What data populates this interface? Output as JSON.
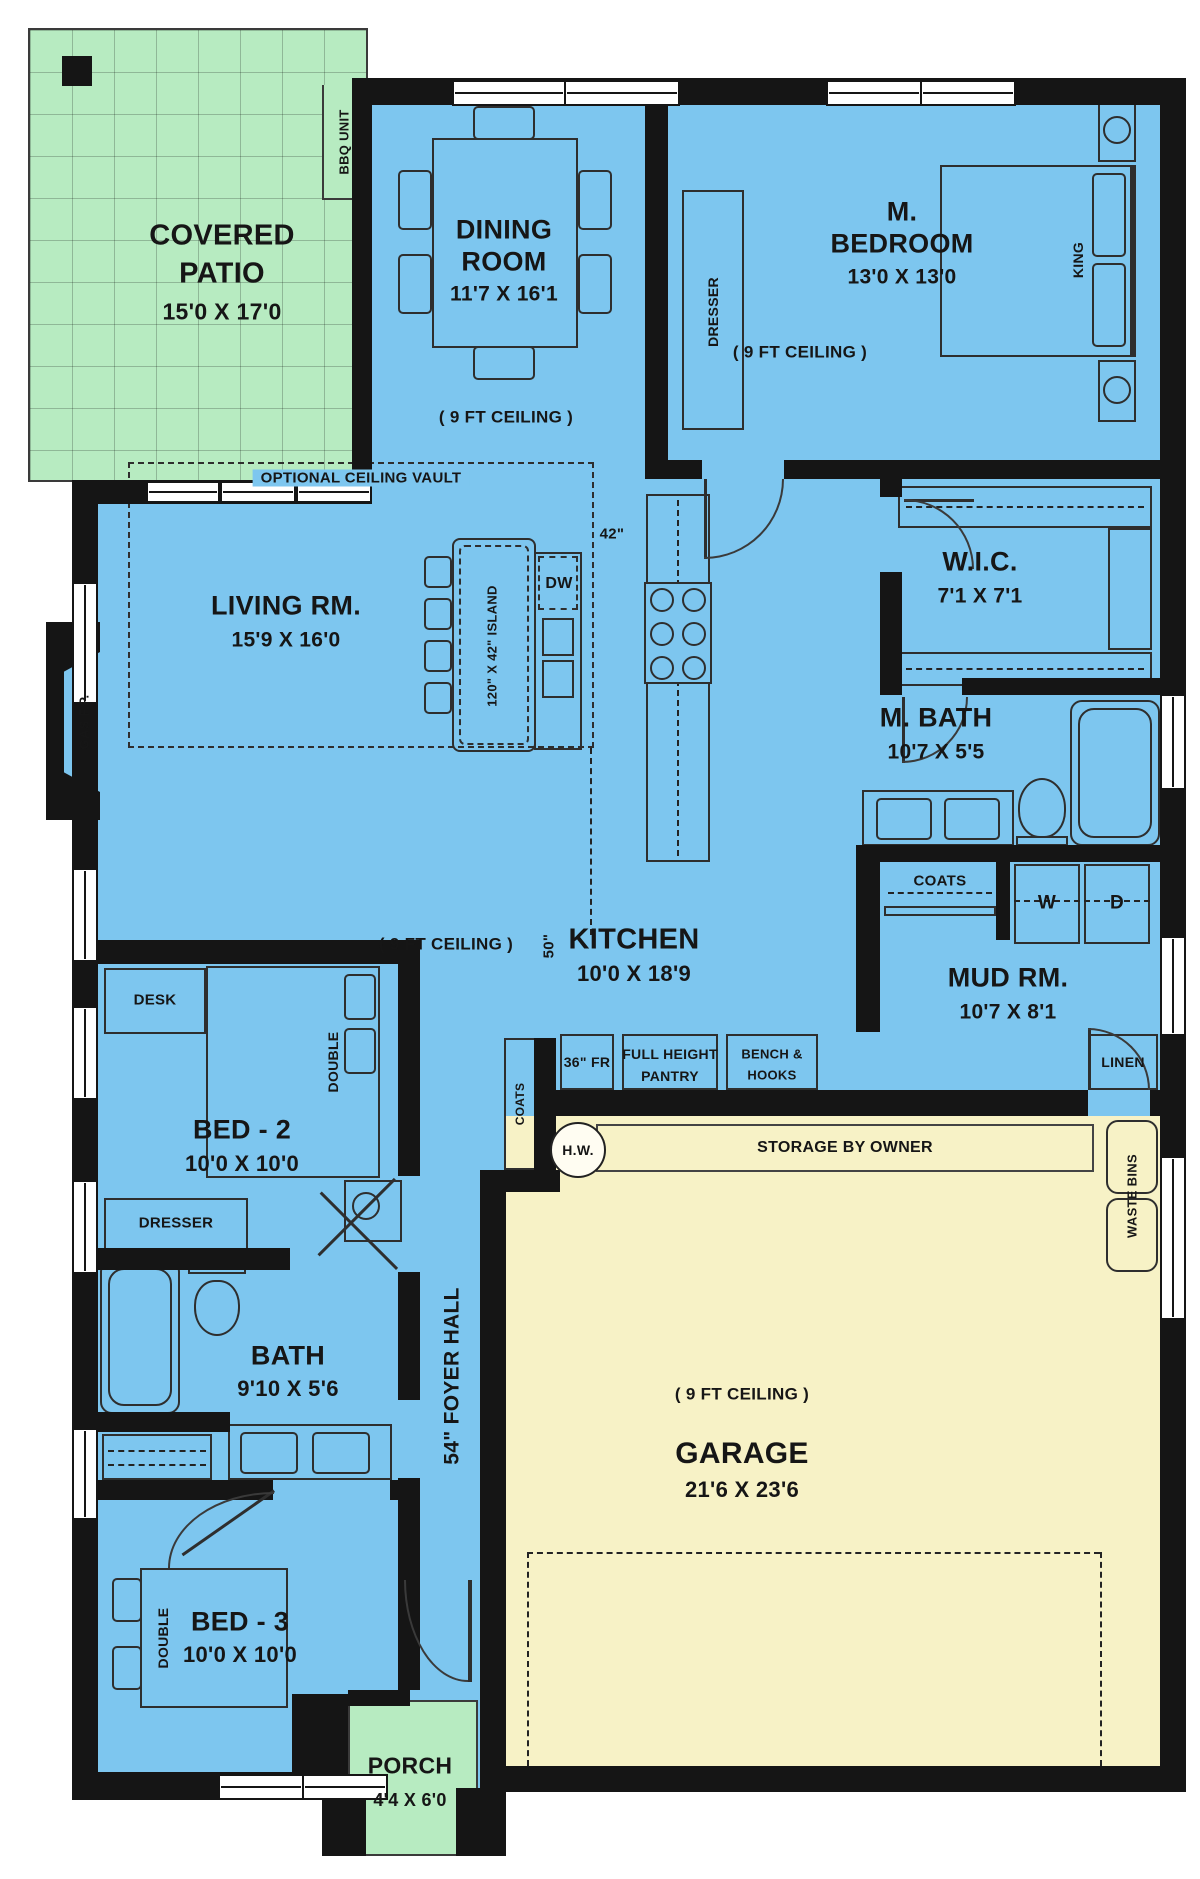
{
  "colors": {
    "interior": "#7dc6ef",
    "patio": "#b7ebc1",
    "garage": "#f7f2c6",
    "wall": "#151515"
  },
  "rooms": {
    "patio": {
      "line1": "COVERED",
      "line2": "PATIO",
      "dims": "15'0 X 17'0",
      "bbq": "BBQ UNIT"
    },
    "dining": {
      "line1": "DINING",
      "line2": "ROOM",
      "dims": "11'7 X 16'1",
      "ceiling": "( 9 FT CEILING )"
    },
    "master": {
      "line1": "M.",
      "line2": "BEDROOM",
      "dims": "13'0 X 13'0",
      "ceiling": "( 9 FT CEILING )",
      "king": "KING",
      "dresser": "DRESSER"
    },
    "wic": {
      "name": "W.I.C.",
      "dims": "7'1 X 7'1"
    },
    "mbath": {
      "name": "M. BATH",
      "dims": "10'7 X 5'5"
    },
    "living": {
      "name": "LIVING RM.",
      "dims": "15'9 X 16'0",
      "vault": "OPTIONAL CEILING VAULT",
      "fireplace": "GAS F.P."
    },
    "kitchen": {
      "name": "KITCHEN",
      "dims": "10'0 X 18'9",
      "ceiling": "( 9 FT CEILING )",
      "island": "120\" X 42\" ISLAND",
      "dw": "DW",
      "note42": "42\"",
      "note50": "50\"",
      "fridge": "36\" FR"
    },
    "pantry": {
      "line1": "FULL HEIGHT",
      "line2": "PANTRY"
    },
    "mud": {
      "name": "MUD RM.",
      "dims": "10'7 X 8'1",
      "washer": "W",
      "dryer": "D",
      "coats_upper": "COATS",
      "coats_foyer": "COATS",
      "bench1": "BENCH &",
      "bench2": "HOOKS",
      "linen": "LINEN"
    },
    "garage": {
      "name": "GARAGE",
      "dims": "21'6 X 23'6",
      "ceiling": "( 9 FT CEILING )",
      "storage": "STORAGE BY OWNER",
      "hw": "H.W.",
      "waste": "WASTE BINS"
    },
    "foyer": {
      "name": "54\" FOYER HALL"
    },
    "bed2": {
      "name": "BED - 2",
      "dims": "10'0 X 10'0",
      "desk": "DESK",
      "double": "DOUBLE",
      "dresser": "DRESSER"
    },
    "bath": {
      "name": "BATH",
      "dims": "9'10 X 5'6"
    },
    "bed3": {
      "name": "BED - 3",
      "dims": "10'0 X 10'0",
      "double": "DOUBLE"
    },
    "porch": {
      "name": "PORCH",
      "dims": "4'4 X 6'0"
    }
  }
}
